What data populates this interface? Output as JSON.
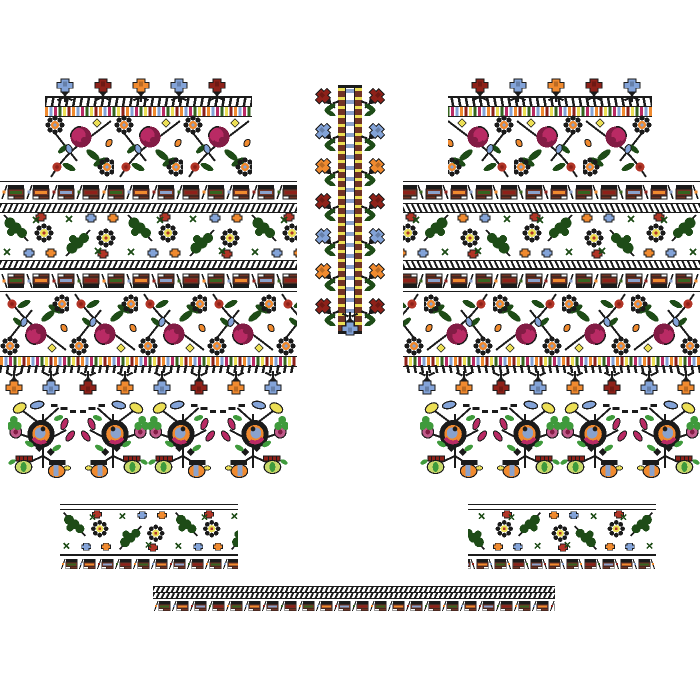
{
  "meta": {
    "description": "Cross-stitch embroidery pattern sheet (vyshyvanka shirt layout): two mirrored sleeve panels, center neckband strip, flower bouquets, two cuff bands and a hem border",
    "background": "#ffffff",
    "canvas": {
      "width": 700,
      "height": 700
    }
  },
  "palette": {
    "black": "#1b1b1b",
    "white": "#ffffff",
    "darkGreen": "#1e4c17",
    "green": "#3f9a3c",
    "paleGreen": "#c9d96a",
    "olive": "#35641f",
    "magenta": "#b92a64",
    "darkMagenta": "#831c45",
    "pink": "#c05a8a",
    "red": "#b23527",
    "darkRed": "#8e2119",
    "orange": "#f08a2f",
    "blue": "#83a3d8",
    "slate": "#8aa2cc",
    "yellow": "#ecdf55",
    "maroon": "#713425"
  },
  "sequences": {
    "top_row": [
      "blue",
      "darkRed",
      "orange",
      "blue",
      "darkRed"
    ],
    "hanging_row": [
      "orange",
      "blue",
      "darkRed"
    ],
    "center_flowers": [
      "darkRed",
      "blue",
      "orange"
    ],
    "thin_border": [
      "orange",
      "blue",
      "magenta",
      "olive",
      "yellow",
      "darkRed"
    ],
    "geo_stripes": [
      "olive",
      "orange",
      "slate",
      "darkRed"
    ]
  },
  "elements": [
    {
      "g": "left-panel",
      "n": "sleeve-top-flower-row",
      "t": "flowerRow",
      "x": 45,
      "y": 78,
      "w": 207,
      "h": 28,
      "o": {
        "dir": "up",
        "seq": "top_row",
        "sp": 38,
        "off": 8
      }
    },
    {
      "g": "left-panel",
      "n": "thin-multicolor-border",
      "t": "thinBorder",
      "x": 45,
      "y": 106,
      "w": 207,
      "h": 9
    },
    {
      "g": "left-panel",
      "n": "rose-band",
      "t": "roseBand",
      "x": 45,
      "y": 115,
      "w": 207,
      "h": 66
    },
    {
      "g": "left-panel",
      "n": "geometric-band",
      "t": "geoBand",
      "x": 0,
      "y": 181,
      "w": 297,
      "h": 22
    },
    {
      "g": "left-panel",
      "n": "zigzag-border",
      "t": "zigzag",
      "x": 0,
      "y": 203,
      "w": 297,
      "h": 8
    },
    {
      "g": "left-panel",
      "n": "oak-floral-band",
      "t": "oakBand",
      "x": 0,
      "y": 211,
      "w": 297,
      "h": 49
    },
    {
      "g": "left-panel",
      "n": "zigzag-border",
      "t": "zigzag",
      "x": 0,
      "y": 260,
      "w": 297,
      "h": 8
    },
    {
      "g": "left-panel",
      "n": "geometric-band-flipped",
      "t": "geoBand",
      "x": 0,
      "y": 268,
      "w": 297,
      "h": 22,
      "o": {
        "flip": true
      }
    },
    {
      "g": "left-panel",
      "n": "rose-band-flipped",
      "t": "roseBand",
      "x": 0,
      "y": 290,
      "w": 297,
      "h": 66,
      "o": {
        "flip": true
      }
    },
    {
      "g": "left-panel",
      "n": "thin-multicolor-border",
      "t": "thinBorder",
      "x": 0,
      "y": 356,
      "w": 297,
      "h": 9
    },
    {
      "g": "left-panel",
      "n": "hanging-flower-row",
      "t": "flowerRow",
      "x": 0,
      "y": 365,
      "w": 297,
      "h": 30,
      "o": {
        "dir": "down",
        "seq": "hanging_row",
        "sp": 37,
        "off": 2
      }
    },
    {
      "g": "right-panel",
      "n": "sleeve-top-flower-row",
      "t": "flowerRow",
      "x": 448,
      "y": 78,
      "w": 204,
      "h": 28,
      "o": {
        "dir": "up",
        "seq": "top_row",
        "sp": 38,
        "off": 8,
        "mirror": true
      }
    },
    {
      "g": "right-panel",
      "n": "thin-multicolor-border",
      "t": "thinBorder",
      "x": 448,
      "y": 106,
      "w": 204,
      "h": 9,
      "o": {
        "mirror": true
      }
    },
    {
      "g": "right-panel",
      "n": "rose-band",
      "t": "roseBand",
      "x": 448,
      "y": 115,
      "w": 204,
      "h": 66,
      "o": {
        "mirror": true
      }
    },
    {
      "g": "right-panel",
      "n": "geometric-band",
      "t": "geoBand",
      "x": 403,
      "y": 181,
      "w": 297,
      "h": 22,
      "o": {
        "mirror": true
      }
    },
    {
      "g": "right-panel",
      "n": "zigzag-border",
      "t": "zigzag",
      "x": 403,
      "y": 203,
      "w": 297,
      "h": 8,
      "o": {
        "mirror": true
      }
    },
    {
      "g": "right-panel",
      "n": "oak-floral-band",
      "t": "oakBand",
      "x": 403,
      "y": 211,
      "w": 297,
      "h": 49,
      "o": {
        "mirror": true
      }
    },
    {
      "g": "right-panel",
      "n": "zigzag-border",
      "t": "zigzag",
      "x": 403,
      "y": 260,
      "w": 297,
      "h": 8,
      "o": {
        "mirror": true
      }
    },
    {
      "g": "right-panel",
      "n": "geometric-band-flipped",
      "t": "geoBand",
      "x": 403,
      "y": 268,
      "w": 297,
      "h": 22,
      "o": {
        "mirror": true,
        "flip": true
      }
    },
    {
      "g": "right-panel",
      "n": "rose-band-flipped",
      "t": "roseBand",
      "x": 403,
      "y": 290,
      "w": 297,
      "h": 66,
      "o": {
        "mirror": true,
        "flip": true
      }
    },
    {
      "g": "right-panel",
      "n": "thin-multicolor-border",
      "t": "thinBorder",
      "x": 403,
      "y": 356,
      "w": 297,
      "h": 9,
      "o": {
        "mirror": true
      }
    },
    {
      "g": "right-panel",
      "n": "hanging-flower-row",
      "t": "flowerRow",
      "x": 403,
      "y": 365,
      "w": 297,
      "h": 30,
      "o": {
        "dir": "down",
        "seq": "hanging_row",
        "sp": 37,
        "off": 2,
        "mirror": true
      }
    },
    {
      "g": "center-strip",
      "n": "neckband-column",
      "t": "centerStrip",
      "x": 315,
      "y": 85,
      "w": 70,
      "h": 253
    },
    {
      "g": "bouquets-left",
      "n": "flower-bouquet",
      "t": "bouquet",
      "x": 8,
      "y": 398,
      "w": 70,
      "h": 82
    },
    {
      "g": "bouquets-left",
      "n": "flower-bouquet",
      "t": "bouquet",
      "x": 78,
      "y": 398,
      "w": 70,
      "h": 82,
      "o": {
        "mirror": true
      }
    },
    {
      "g": "bouquets-left",
      "n": "flower-bouquet",
      "t": "bouquet",
      "x": 148,
      "y": 398,
      "w": 70,
      "h": 82
    },
    {
      "g": "bouquets-left",
      "n": "flower-bouquet",
      "t": "bouquet",
      "x": 218,
      "y": 398,
      "w": 70,
      "h": 82,
      "o": {
        "mirror": true
      }
    },
    {
      "g": "bouquets-right",
      "n": "flower-bouquet",
      "t": "bouquet",
      "x": 420,
      "y": 398,
      "w": 70,
      "h": 82
    },
    {
      "g": "bouquets-right",
      "n": "flower-bouquet",
      "t": "bouquet",
      "x": 490,
      "y": 398,
      "w": 70,
      "h": 82,
      "o": {
        "mirror": true
      }
    },
    {
      "g": "bouquets-right",
      "n": "flower-bouquet",
      "t": "bouquet",
      "x": 560,
      "y": 398,
      "w": 70,
      "h": 82
    },
    {
      "g": "bouquets-right",
      "n": "flower-bouquet",
      "t": "bouquet",
      "x": 630,
      "y": 398,
      "w": 70,
      "h": 82,
      "o": {
        "mirror": true
      }
    },
    {
      "g": "cuff-left",
      "n": "cuff-band",
      "t": "cuff",
      "x": 60,
      "y": 504,
      "w": 178,
      "h": 68
    },
    {
      "g": "cuff-right",
      "n": "cuff-band",
      "t": "cuff",
      "x": 468,
      "y": 504,
      "w": 188,
      "h": 68,
      "o": {
        "mirror": true
      }
    },
    {
      "g": "hem-border",
      "n": "hem-strip",
      "t": "hem",
      "x": 153,
      "y": 586,
      "w": 402,
      "h": 28
    }
  ]
}
